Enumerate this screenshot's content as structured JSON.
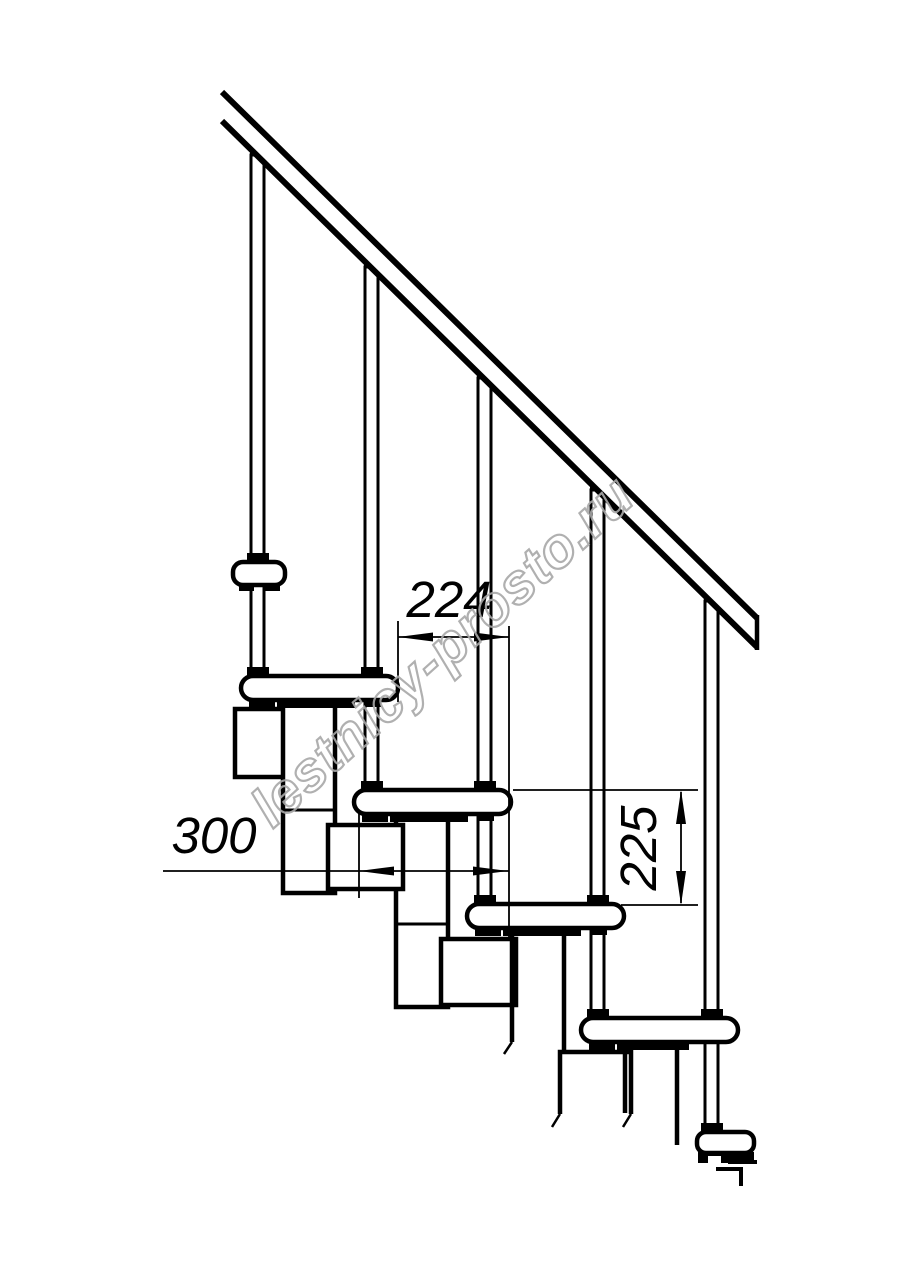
{
  "drawing": {
    "watermark": "lestnicy-prosto.ru",
    "dimensions": {
      "step_run": "224",
      "tread_depth": "300",
      "step_rise": "225"
    },
    "colors": {
      "line": "#000000",
      "background": "#ffffff",
      "watermark": "#a8a8a8"
    }
  }
}
